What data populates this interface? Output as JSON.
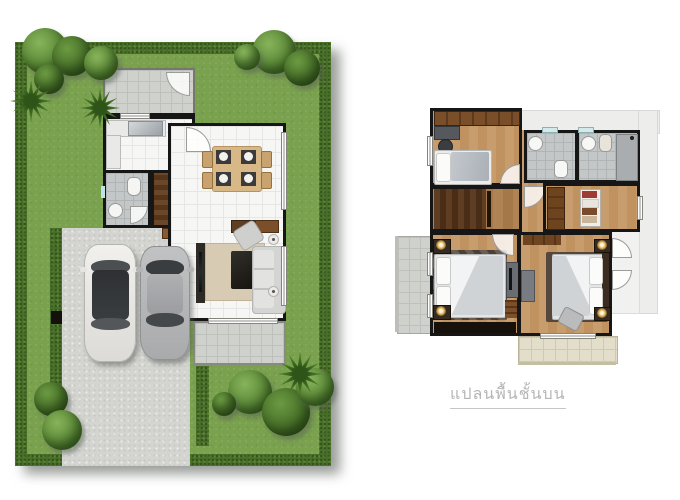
{
  "caption": {
    "text": "แปลนพื้นชั้นบน"
  },
  "palette": {
    "lawn": "#7aa14e",
    "hedge": "#486f28",
    "concrete": "#d4d5d1",
    "floor_tile": "#f6f6f4",
    "wall": "#161616",
    "wood_light": "#c89d6e",
    "wood_dark": "#5f3d22",
    "bath_tile": "#c3c7c8",
    "terrace_tile": "#cfd1cd",
    "balcony_tile": "#e3deca",
    "rug": "#d8cbb4",
    "sofa": "#d4d4d2",
    "caption_gray": "#b5b5b5",
    "car_white": "#f1f0ed",
    "car_silver": "#b5b7b9"
  }
}
